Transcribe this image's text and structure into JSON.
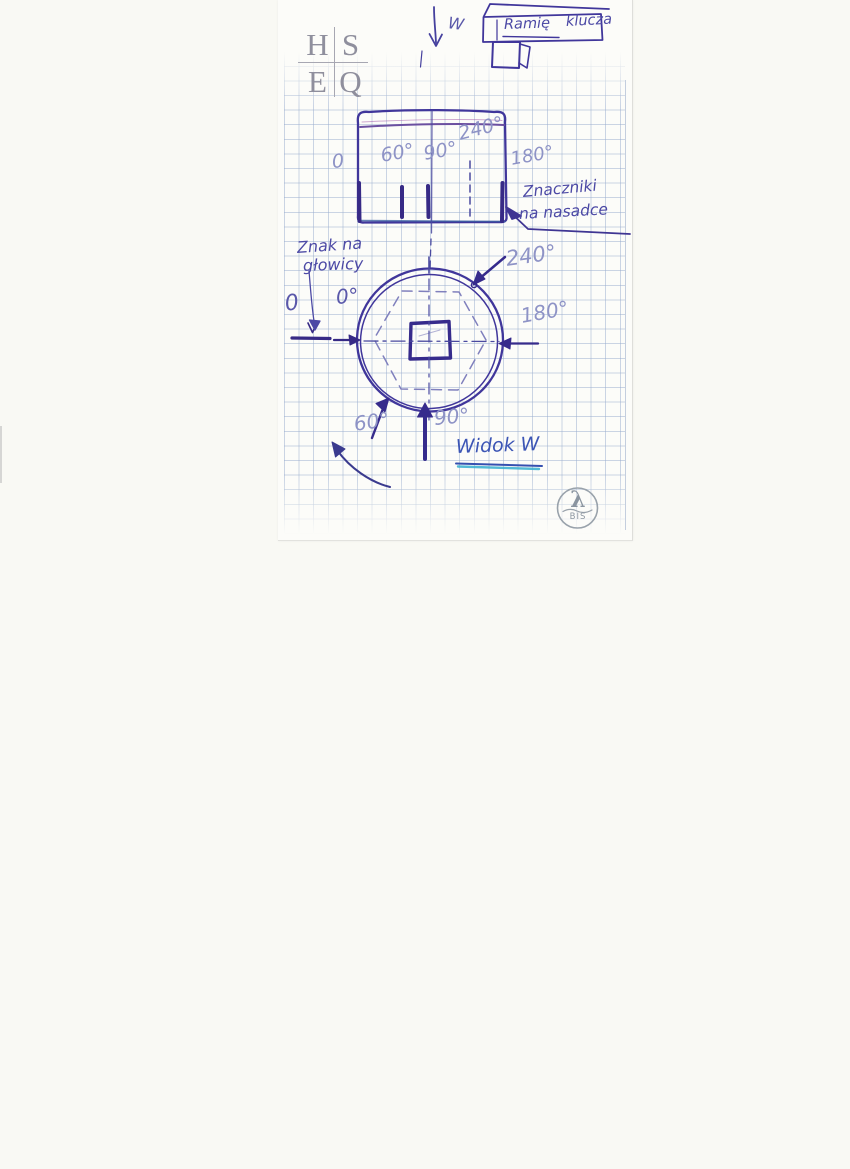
{
  "colors": {
    "background": "#f9f9f4",
    "paper": "#fcfcf9",
    "grid_line": "#98acce",
    "ink_main": "#40369b",
    "ink_thick": "#372a86",
    "ink_faded_label": "#8e93c6",
    "ink_note": "#4c49a5",
    "caption_blue": "#3c55b5",
    "underline_cyan": "#35aed0",
    "logo_gray": "#8f8f9d"
  },
  "hseq_logo": {
    "top_left": "H",
    "top_right": "S",
    "bottom_left": "E",
    "bottom_right": "Q"
  },
  "view_direction": {
    "arrow_label": "W"
  },
  "wrench_sketch": {
    "label_inside": "Ramię",
    "label_outside": "klucza"
  },
  "socket_side_view": {
    "angle_labels": {
      "deg0": "0",
      "deg60": "60°",
      "deg90": "90°",
      "deg240": "240°",
      "deg180": "180°"
    },
    "annotation": {
      "line1": "Znaczniki",
      "line2": "na nasadce"
    }
  },
  "socket_top_view": {
    "annotation": {
      "line1": "Znak na",
      "line2": "głowicy"
    },
    "angle_labels": {
      "zero": "0",
      "deg0": "0°",
      "deg60": "60°",
      "deg90": "90°",
      "deg180": "180°",
      "deg240": "240°"
    },
    "caption": "Widok W"
  },
  "bis_logo": {
    "symbol": "λ",
    "text": "BIS"
  }
}
